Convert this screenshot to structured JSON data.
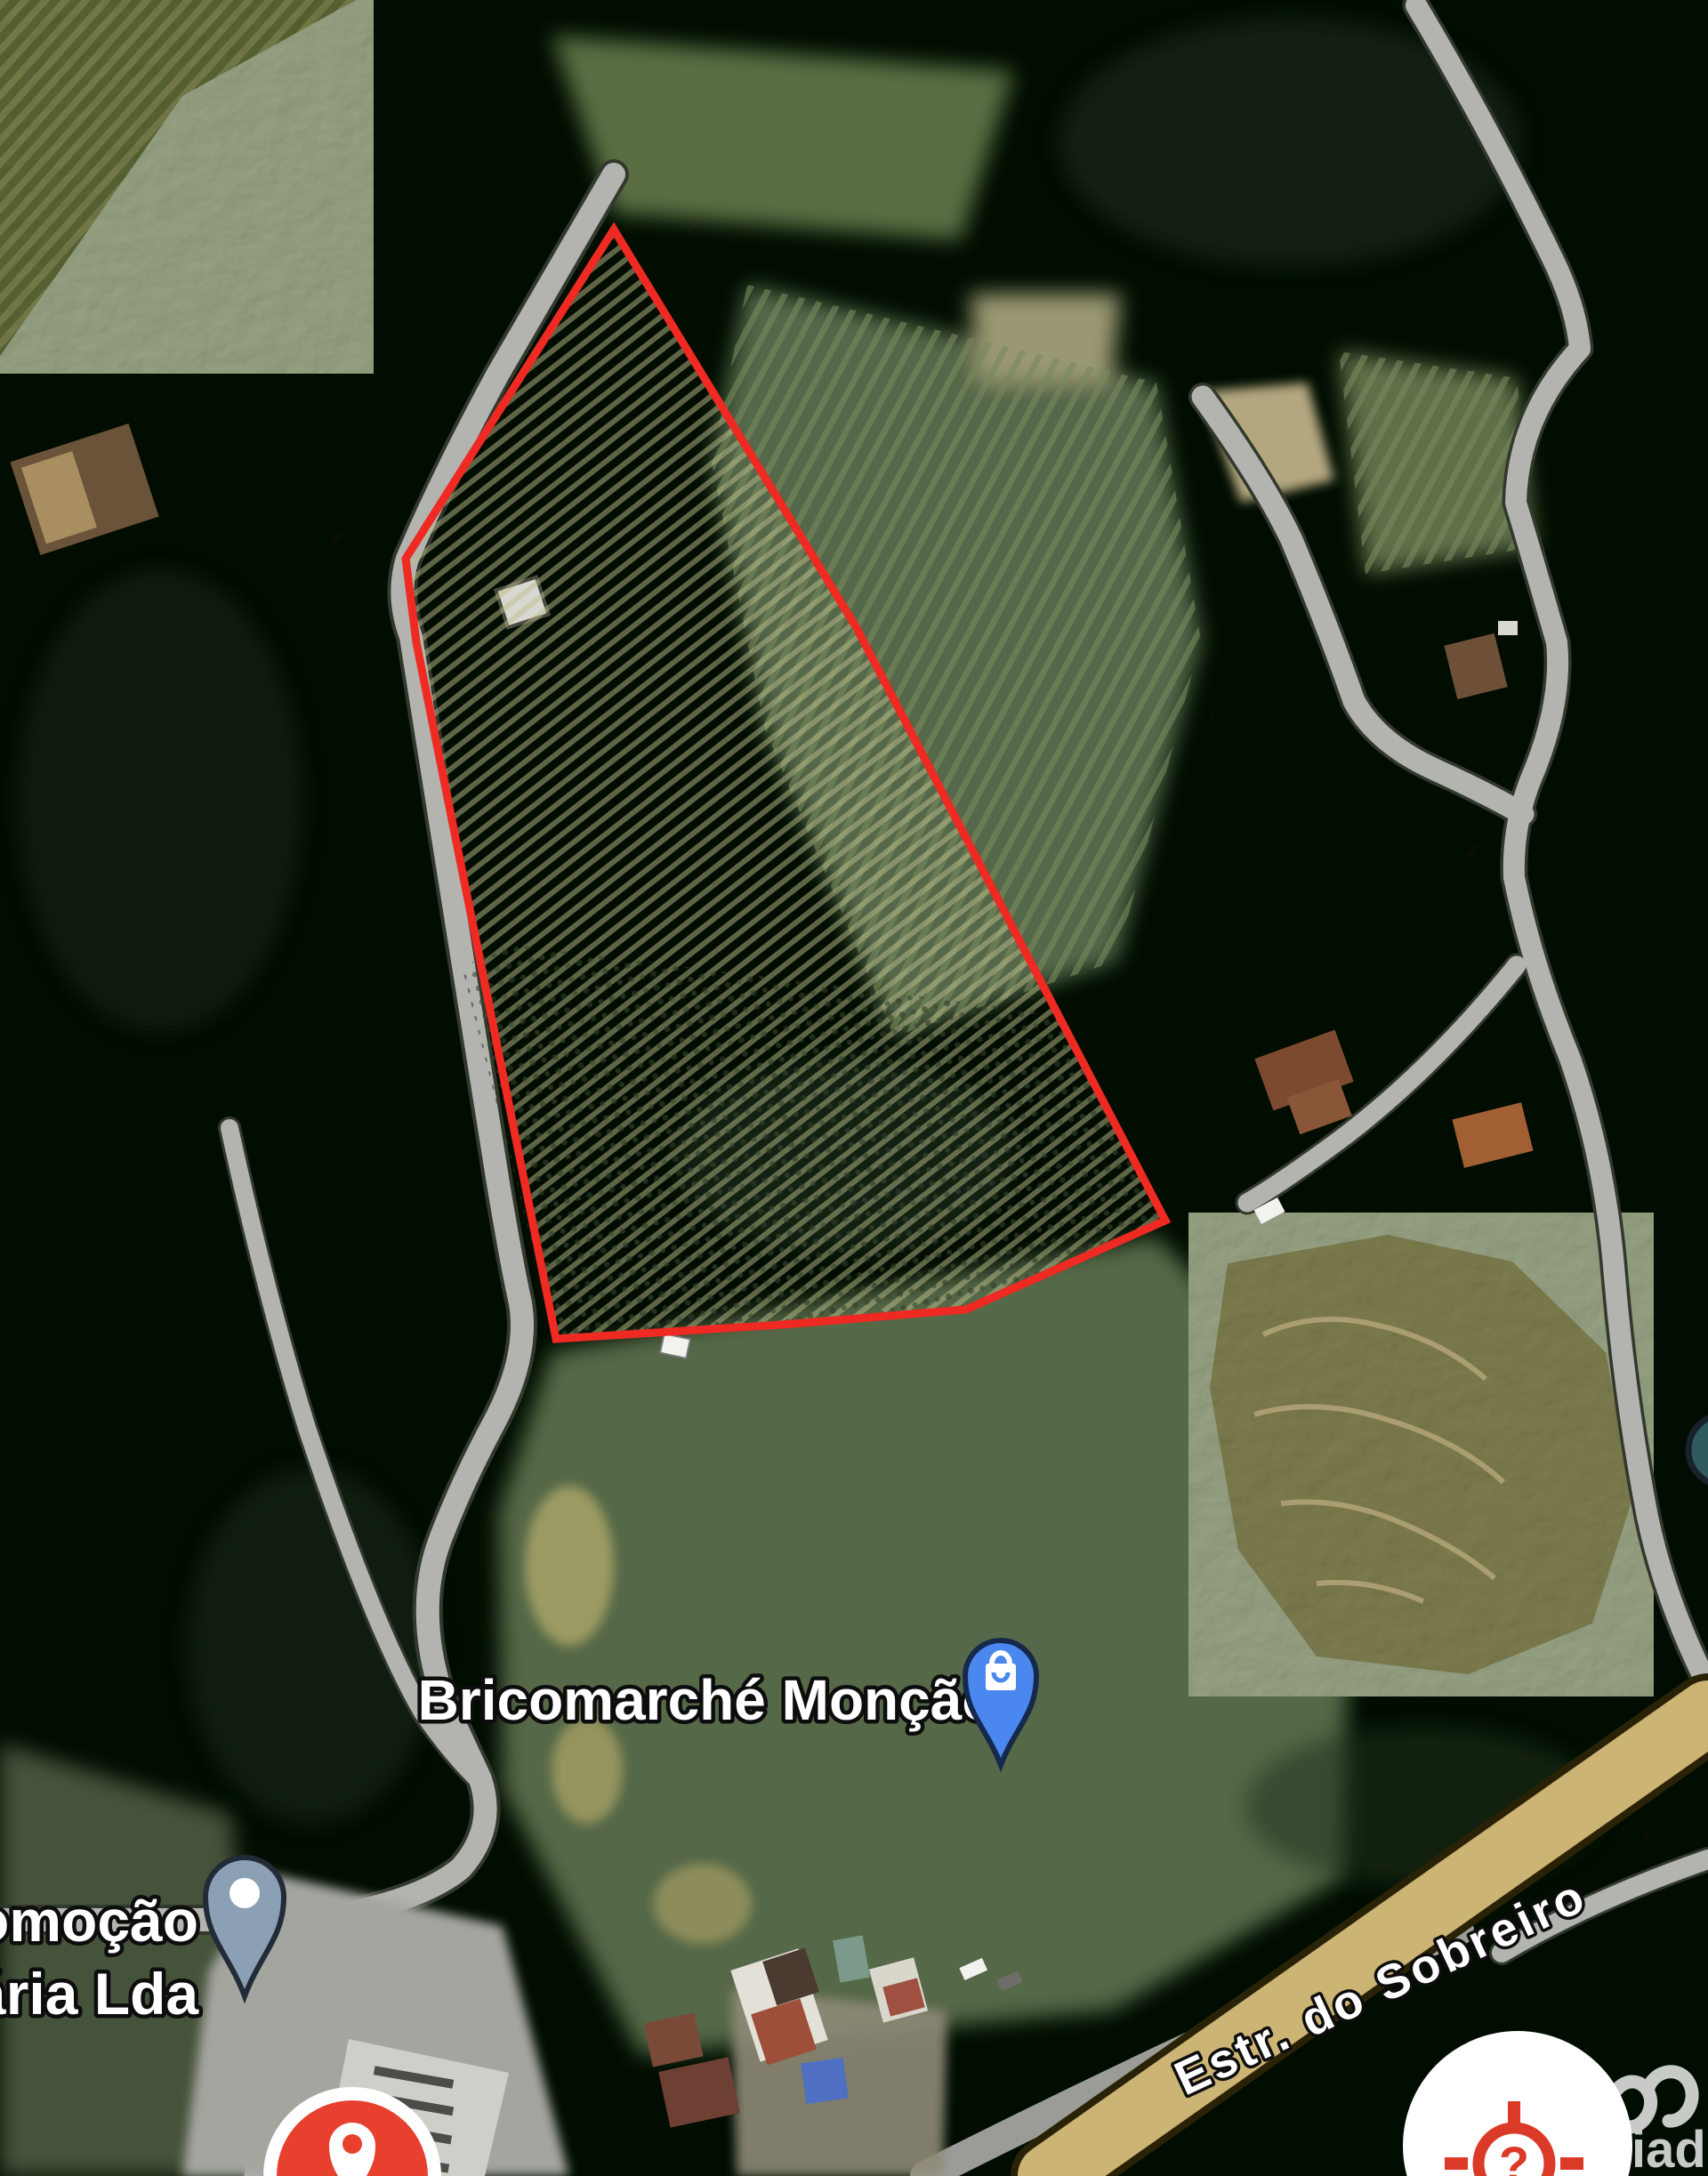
{
  "map": {
    "labels": {
      "poi_main": "Bricomarché Monção",
      "poi_partial_line1": "omoção",
      "poi_partial_line2": "ária Lda",
      "road_name": "Estr. do Sobreiro"
    },
    "watermark_text": "iad",
    "buttons": {
      "help_glyph": "?"
    },
    "colors": {
      "boundary_red": "#ee2a22",
      "poi_pin_blue": "#4a87ee",
      "generic_pin_gray": "#8ba0b4",
      "button_red": "#e8402f",
      "icon_red": "#dc3a28",
      "road_major_tan": "#ccb475",
      "road_minor_gray": "#b3b3b0",
      "label_white": "#ffffff"
    },
    "icons": [
      "shopping-bag-pin-icon",
      "generic-location-pin-icon",
      "location-pin-button-icon",
      "crosshair-question-icon",
      "iad-logo-icon"
    ]
  }
}
